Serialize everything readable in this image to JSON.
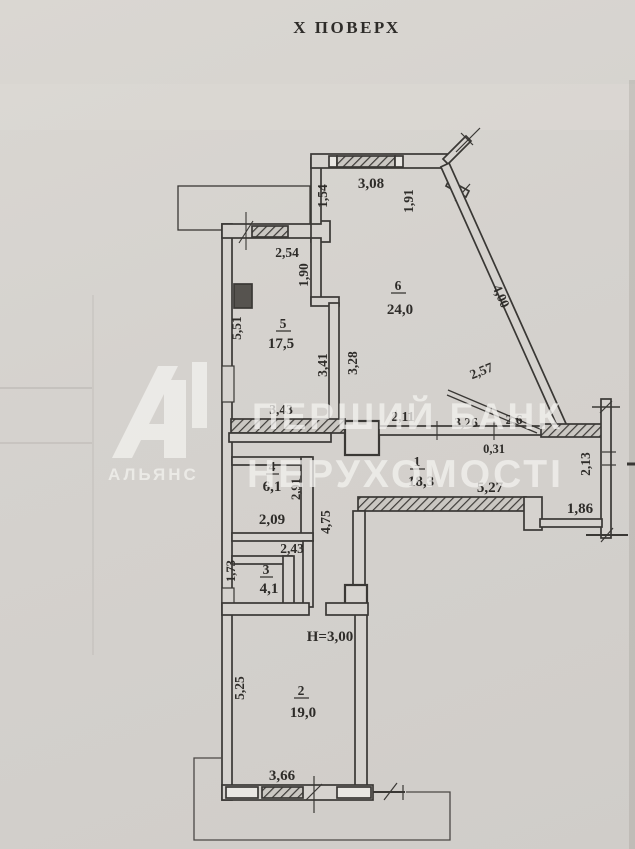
{
  "title": "Х ПОВЕРХ",
  "watermark": {
    "line1": "ПЕРШИЙ БАНК",
    "line2": "НЕРУХОМОСТІ",
    "logo_text": "АЛЬЯНС"
  },
  "plan": {
    "ceiling_height": "Н=3,00",
    "rooms": [
      {
        "number": "5",
        "area": "17,5"
      },
      {
        "number": "6",
        "area": "24,0"
      },
      {
        "number": "1",
        "area": "18,3"
      },
      {
        "number": "4",
        "area": "6,1"
      },
      {
        "number": "3",
        "area": "4,1"
      },
      {
        "number": "2",
        "area": "19,0"
      }
    ],
    "dims": {
      "room5_window": "2,54",
      "room6_left_upper": "1,54",
      "room6_window": "3,08",
      "room6_right_upper": "1,91",
      "room5_right_upper": "1,90",
      "room5_left": "5,51",
      "room5_right_lower": "3,41",
      "room6_left_lower": "3,28",
      "room6_diagonal_wall": "4,00",
      "room6_diagonal_cut": "2,57",
      "room5_bottom": "3,43",
      "hall_top_a": "2,11",
      "hall_top_b": "3,26",
      "hall_top_c": "2,6",
      "wall_thickness": "0,31",
      "hall_bottom": "5,27",
      "niche_bottom": "1,86",
      "niche_right": "2,13",
      "room4_right": "2,91",
      "room4_bottom": "2,09",
      "hall_leg": "4,75",
      "room3_top": "2,43",
      "room3_left": "1,73",
      "room2_left": "5,25",
      "room2_window": "3,66"
    }
  }
}
